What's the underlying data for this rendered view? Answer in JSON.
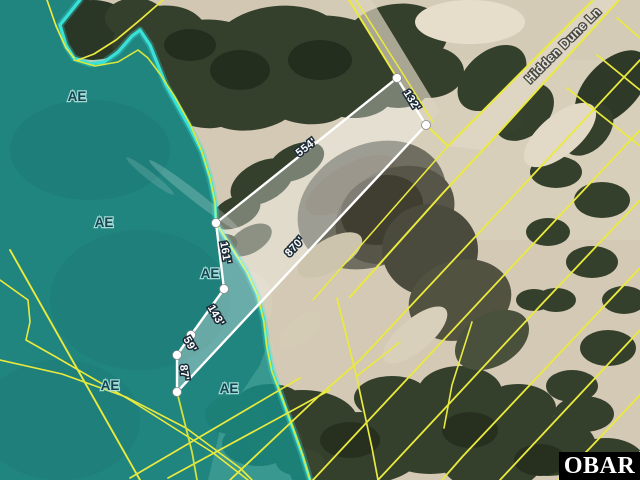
{
  "map": {
    "street_label": "Hidden Dune Ln",
    "flood_zone_labels": [
      "AE",
      "AE",
      "AE",
      "AE",
      "AE"
    ],
    "dimensions": [
      "554'",
      "132'",
      "870'",
      "161'",
      "143'",
      "59'",
      "87'"
    ],
    "colors": {
      "flood_zone_teal": "#178e88",
      "shoreline_cyan": "#38e2d9",
      "parcel_line_yellow": "#eaea3e",
      "subject_parcel_white": "#ffffff"
    }
  },
  "watermark": {
    "text": "OBAR"
  }
}
